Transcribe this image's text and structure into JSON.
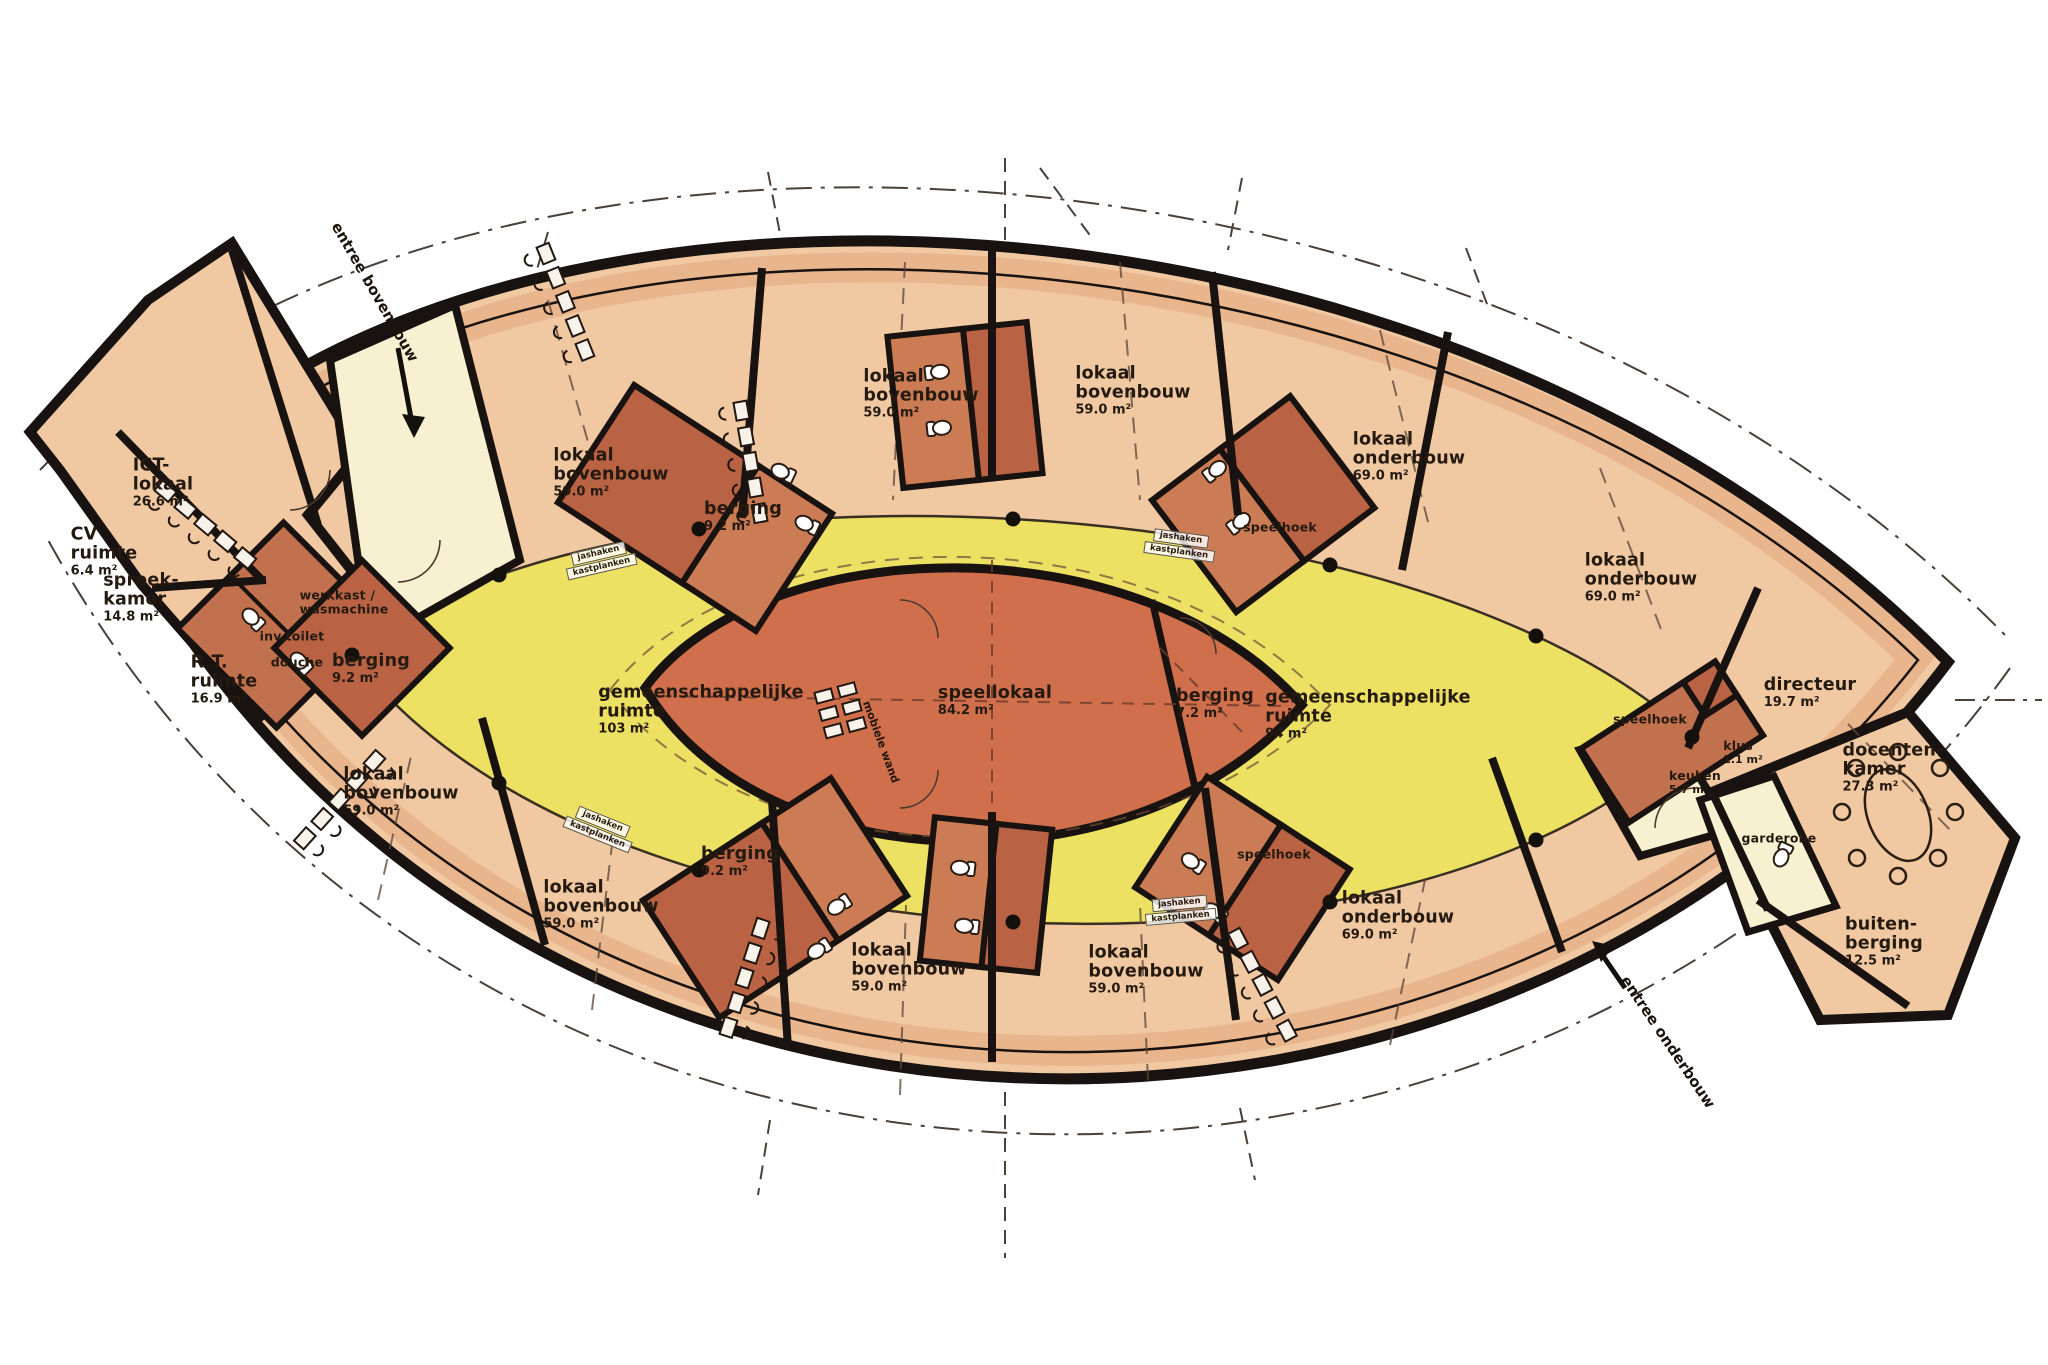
{
  "title": "schoolgebouw plattegrond",
  "colors": {
    "paper": "#ffffff",
    "classroom_fill": "#f0c8a2",
    "classroom_edge_band": "#dd9e72",
    "service_block_dark": "#b96344",
    "service_block_light": "#cb7c55",
    "common_hall_yellow": "#ece163",
    "entry_pale": "#f7f1d2",
    "speellokaal_fill": "#d06f4c",
    "wall_black": "#181210",
    "dashed_line": "#4a4038"
  },
  "icons": {
    "entry_arrow": "arrow-icon",
    "toilet": "toilet-icon",
    "desk_with_chair": "desk-icon",
    "oval_table": "table-icon",
    "column_dot": "column-icon"
  },
  "rooms": [
    {
      "name": "CV\nruimte",
      "area": "6.4 m²"
    },
    {
      "name": "ICT-\nlokaal",
      "area": "26.6 m²"
    },
    {
      "name": "spreek-\nkamer",
      "area": "14.8 m²"
    },
    {
      "name": "R.T.\nruimte",
      "area": "16.9 m²"
    },
    {
      "name": "werkkast /\nwasmachine",
      "area": ""
    },
    {
      "name": "inv.toilet",
      "area": ""
    },
    {
      "name": "douche",
      "area": ""
    },
    {
      "name": "berging",
      "area": "9.2 m²"
    },
    {
      "name": "lokaal\nbovenbouw",
      "area": "59.0 m²"
    },
    {
      "name": "lokaal\nbovenbouw",
      "area": "59.0 m²"
    },
    {
      "name": "berging",
      "area": "9.2 m²"
    },
    {
      "name": "lokaal\nbovenbouw",
      "area": "59.0 m²"
    },
    {
      "name": "lokaal\nbovenbouw",
      "area": "59.0 m²"
    },
    {
      "name": "speelhoek",
      "area": ""
    },
    {
      "name": "lokaal\nonderbouw",
      "area": "69.0 m²"
    },
    {
      "name": "lokaal\nonderbouw",
      "area": "69.0 m²"
    },
    {
      "name": "directeur",
      "area": "19.7 m²"
    },
    {
      "name": "speelhoek",
      "area": ""
    },
    {
      "name": "klus",
      "area": "1.1 m²"
    },
    {
      "name": "keuken",
      "area": "5.7 m²"
    },
    {
      "name": "docenten-\nkamer",
      "area": "27.3 m²"
    },
    {
      "name": "garderobe",
      "area": ""
    },
    {
      "name": "buiten-\nberging",
      "area": "12.5 m²"
    },
    {
      "name": "lokaal\nonderbouw",
      "area": "69.0 m²"
    },
    {
      "name": "speelhoek",
      "area": ""
    },
    {
      "name": "lokaal\nbovenbouw",
      "area": "59.0 m²"
    },
    {
      "name": "lokaal\nbovenbouw",
      "area": "59.0 m²"
    },
    {
      "name": "berging",
      "area": "9.2 m²"
    },
    {
      "name": "lokaal\nbovenbouw",
      "area": "59.0 m²"
    },
    {
      "name": "speellokaal",
      "area": "84.2 m²"
    },
    {
      "name": "berging",
      "area": "7.2 m²"
    },
    {
      "name": "gemeenschappelijke\nruimte",
      "area": "103 m²"
    },
    {
      "name": "gemeenschappelijke\nruimte",
      "area": "94 m²"
    }
  ],
  "annotations": {
    "entree_bovenbouw": "entree bovenbouw",
    "entree_onderbouw": "entree onderbouw",
    "mobiele_wand": "mobiele wand",
    "kastplanken": "kastplanken",
    "jashaken": "jashaken"
  }
}
